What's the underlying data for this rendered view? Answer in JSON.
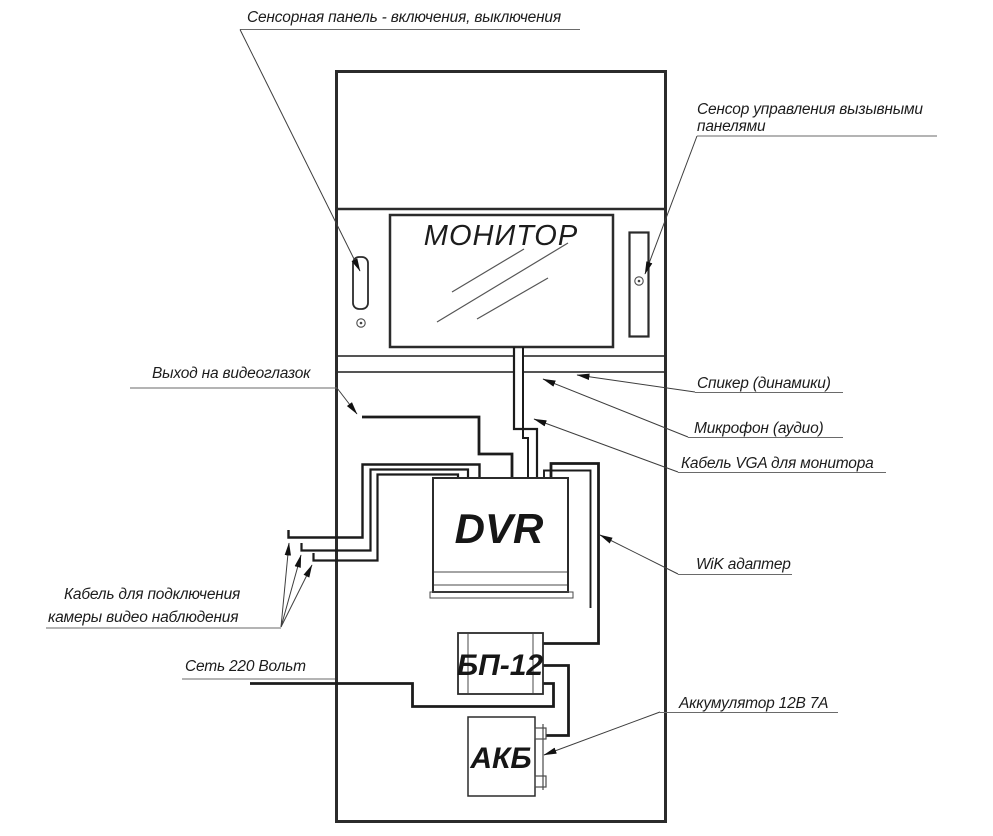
{
  "colors": {
    "background": "#ffffff",
    "outline": "#2b2b2b",
    "cable": "#1b1b1b",
    "text": "#1c1c1c"
  },
  "components": {
    "monitor": "МОНИТОР",
    "dvr": "DVR",
    "psu": "БП-12",
    "battery": "АКБ"
  },
  "annotations": {
    "sensor_panel": "Сенсорная панель - включения, выключения",
    "call_panel_sensor_line1": "Сенсор управления вызывными",
    "call_panel_sensor_line2": "панелями",
    "peephole_out": "Выход на видеоглазок",
    "speaker": "Спикер (динамики)",
    "microphone": "Микрофон (аудио)",
    "vga_cable": "Кабель  VGA  для монитора",
    "wik_adapter": "WiK адаптер",
    "camera_cable_line1": "Кабель для подключения",
    "camera_cable_line2": "камеры видео наблюдения",
    "mains_220": "Сеть 220 Вольт",
    "battery_note": "Аккумулятор 12В 7А"
  }
}
